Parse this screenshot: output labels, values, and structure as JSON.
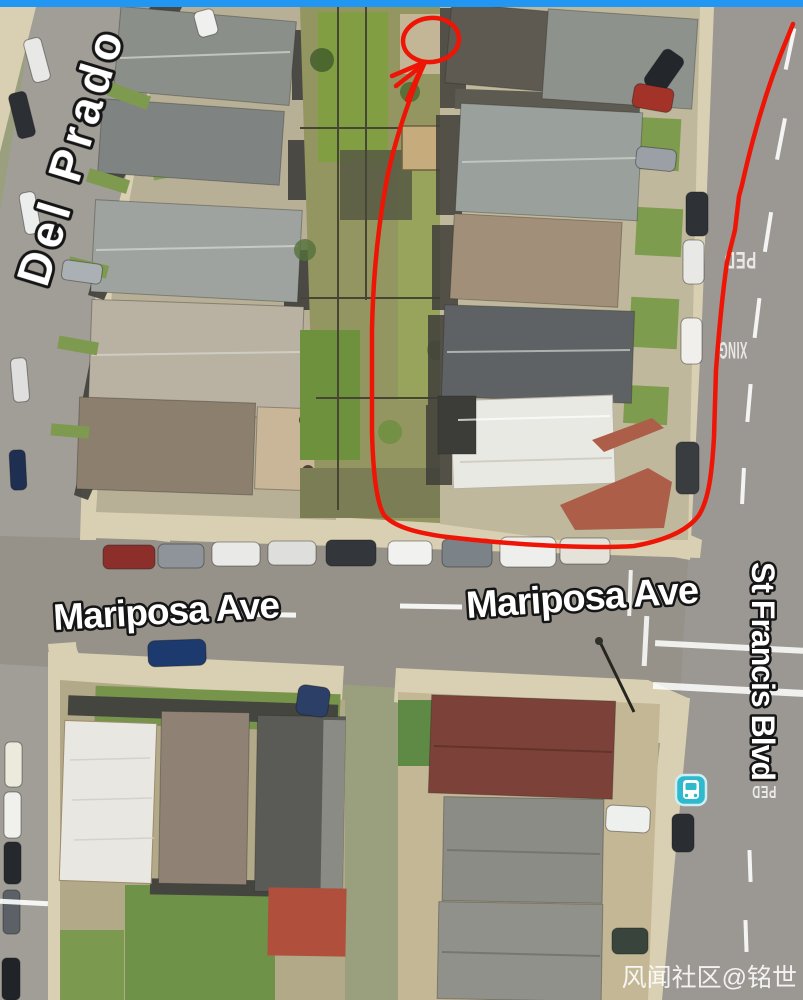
{
  "top_bar": {
    "color": "#2196f3"
  },
  "map": {
    "street_labels": {
      "del_prado": "Del Prado",
      "mariposa_west": "Mariposa Ave",
      "mariposa_east": "Mariposa Ave",
      "st_francis": "St Francis Blvd"
    },
    "road_markings": {
      "ped_upper": "PED",
      "xing_upper": "XING",
      "ped_lower": "PED"
    },
    "transit": {
      "bus_stop_color": "#2eb9cd"
    },
    "annotation": {
      "color": "#ee1506"
    }
  },
  "watermark": {
    "text": "风闻社区@铭世"
  }
}
